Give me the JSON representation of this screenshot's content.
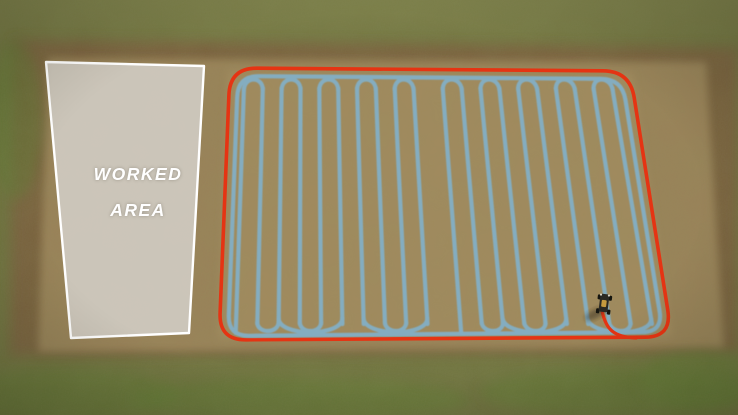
{
  "worked_area": {
    "line1": "WORKED",
    "line2": "AREA"
  },
  "vehicle": {
    "name": "tractor",
    "x": 604,
    "y": 303
  },
  "colors": {
    "boundary": "#e53413",
    "path_blue": "#7fb5d6",
    "panel_fill": "rgba(213,210,204,0.84)",
    "panel_border": "#ffffff",
    "label_text": "#ffffff",
    "grass": "#70743f",
    "grass_light": "#7e814a",
    "green_patch": "#5e7a33",
    "dirt": "#9c845a",
    "dirt_dark": "#7c5f3e",
    "dirt_light": "#a58c5f",
    "tractor_body": "#2a2923",
    "tractor_wheel": "#15150f",
    "tractor_cab": "#c59a3e",
    "shadow": "rgba(45,38,20,0.45)"
  },
  "geometry": {
    "canvas": {
      "w": 738,
      "h": 415
    },
    "panel": {
      "points": [
        [
          46,
          62
        ],
        [
          204,
          66
        ],
        [
          189,
          333
        ],
        [
          71,
          338
        ]
      ]
    },
    "boundary": {
      "corners": [
        [
          230,
          68
        ],
        [
          630,
          71
        ],
        [
          672,
          337
        ],
        [
          219,
          340
        ]
      ],
      "radius": 27
    },
    "perimeter": {
      "corners": [
        [
          238,
          76
        ],
        [
          622,
          79
        ],
        [
          663,
          332
        ],
        [
          228,
          336
        ]
      ],
      "radius": 21
    },
    "rows": {
      "count": 20,
      "x_top": [
        244,
        612
      ],
      "x_bottom": [
        236,
        652
      ],
      "y_top": 86,
      "y_bottom": 324,
      "gap_after": 9,
      "gap_extra": 0.55,
      "top_arcs": [
        [
          0,
          1
        ],
        [
          2,
          3
        ],
        [
          4,
          5
        ],
        [
          6,
          7
        ],
        [
          8,
          9
        ],
        [
          10,
          11
        ],
        [
          12,
          13
        ],
        [
          14,
          15
        ],
        [
          16,
          17
        ],
        [
          18,
          19
        ]
      ],
      "bottom_arcs": [
        [
          1,
          2
        ],
        [
          3,
          4
        ],
        [
          7,
          8
        ],
        [
          11,
          12
        ],
        [
          13,
          14
        ],
        [
          17,
          18
        ]
      ],
      "wide_arcs": [
        [
          2,
          5
        ],
        [
          6,
          9
        ],
        [
          12,
          15
        ],
        [
          16,
          19
        ]
      ],
      "drop_rows": [
        0,
        10
      ]
    },
    "exit_curve": "M 602 311 C 606 329 613 337 636 338"
  }
}
